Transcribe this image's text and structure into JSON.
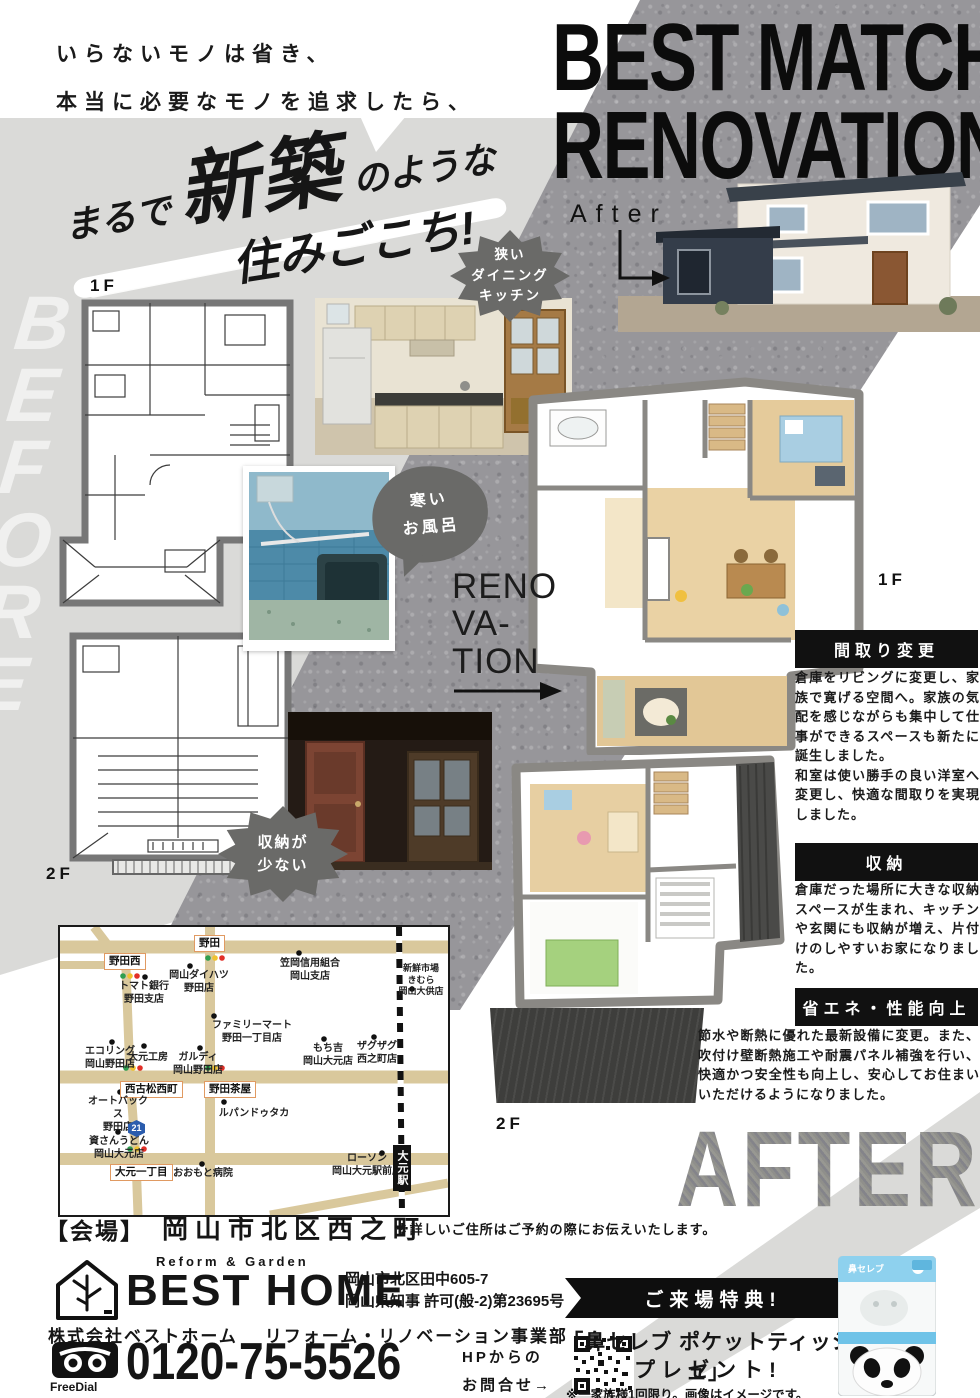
{
  "colors": {
    "light_gray": "#dadad8",
    "concrete": "#97969a",
    "bubble_gray": "#6a6a68",
    "ink": "#111111",
    "map_road": "#d9c89c",
    "map_box_border": "#e09a62",
    "route_blue": "#2b5cad",
    "tissue_blue": "#8ed1ee"
  },
  "catch": {
    "l1a": "いらない",
    "l1b": "モノ",
    "l1c": "は省き、",
    "l2a": "本当に必要な",
    "l2b": "モノ",
    "l2c": "を追求したら、"
  },
  "headline": {
    "p1": "まるで",
    "p2": "新築",
    "p3": "のような",
    "p4": "住みごこち!"
  },
  "watermarks": {
    "before": "BEFORE",
    "after": "AFTER"
  },
  "hero": {
    "title1": "BEST MATCH",
    "title2": "RENOVATION",
    "after_label": "After"
  },
  "bubbles": {
    "kitchen": "狭い\nダイニング\nキッチン",
    "bath": "寒い\nお風呂",
    "storage": "収納が\n少ない"
  },
  "plans": {
    "before_1f": "1F",
    "before_2f": "2F",
    "after_1f": "1F",
    "after_2f": "2F"
  },
  "renovation": {
    "l1": "RENO",
    "l2": "VA-",
    "l3": "TION"
  },
  "sections": [
    {
      "title": "間取り変更",
      "body": "倉庫をリビングに変更し、家族で寛げる空間へ。家族の気配を感じながらも集中して仕事ができるスペースも新たに誕生しました。\n和室は使い勝手の良い洋室へ変更し、快適な間取りを実現しました。"
    },
    {
      "title": "収納",
      "body": "倉庫だった場所に大きな収納スペースが生まれ、キッチンや玄関にも収納が増え、片付けのしやすいお家になりました。"
    },
    {
      "title": "省エネ・性能向上",
      "body": "節水や断熱に優れた最新設備に変更。また、吹付け壁断熱施工や耐震パネル補強を行い、快適かつ安全性も向上し、安心してお住まいいただけるようになりました。"
    }
  ],
  "map": {
    "route_badge": "21",
    "station": "大元駅",
    "boxed": {
      "noda": "野田",
      "nodanishi": "野田西",
      "nishifurumatsu": "西古松西町",
      "nodachaya": "野田茶屋",
      "omoto1": "大元一丁目"
    },
    "pois": {
      "kasaoka": "笠岡信用組合\n岡山支店",
      "shinsen": "新鮮市場\nきむら\n岡山大供店",
      "daihatsu": "岡山ダイハツ\n野田店",
      "tomato": "トマト銀行\n野田支店",
      "familymart": "ファミリーマート\n野田一丁目店",
      "ecoring": "エコリング\n岡山野田店",
      "omotokobo": "大元工房",
      "gurudi": "ガルディ\n岡山野田店",
      "mochikichi": "もち吉\n岡山大元店",
      "zagzag": "ザグザグ\n西之町店",
      "autobacs": "オートバックス\n野田店",
      "lupin": "ルパンドゥタカ",
      "sukesan": "資さんうどん\n岡山大元店",
      "hospital": "おおもと病院",
      "lawson": "ローソン\n岡山大元駅前店"
    }
  },
  "venue": {
    "bracket": "【会場】",
    "place": "岡山市北区西之町",
    "note": "※詳しいご住所はご予約の際にお伝えいたします。"
  },
  "footer": {
    "tagline": "Reform & Garden",
    "brand": "BEST HOME",
    "address": "岡山市北区田中605-7",
    "license": "岡山県知事 許可(般-2)第23695号",
    "company": "株式会社ベストホーム",
    "division": "リフォーム・リノベーション事業部",
    "freedial": "FreeDial",
    "phone": "0120-75-5526",
    "hp_line1": "HPからの",
    "hp_line2": "お問合せ→"
  },
  "promo": {
    "ribbon": "ご来場特典!",
    "line1": "「鼻セレブ ポケットティッシュ」",
    "line2": "プレゼント!",
    "note": "※一家族様1回限り。画像はイメージです。",
    "product_label": "鼻セレブ"
  }
}
